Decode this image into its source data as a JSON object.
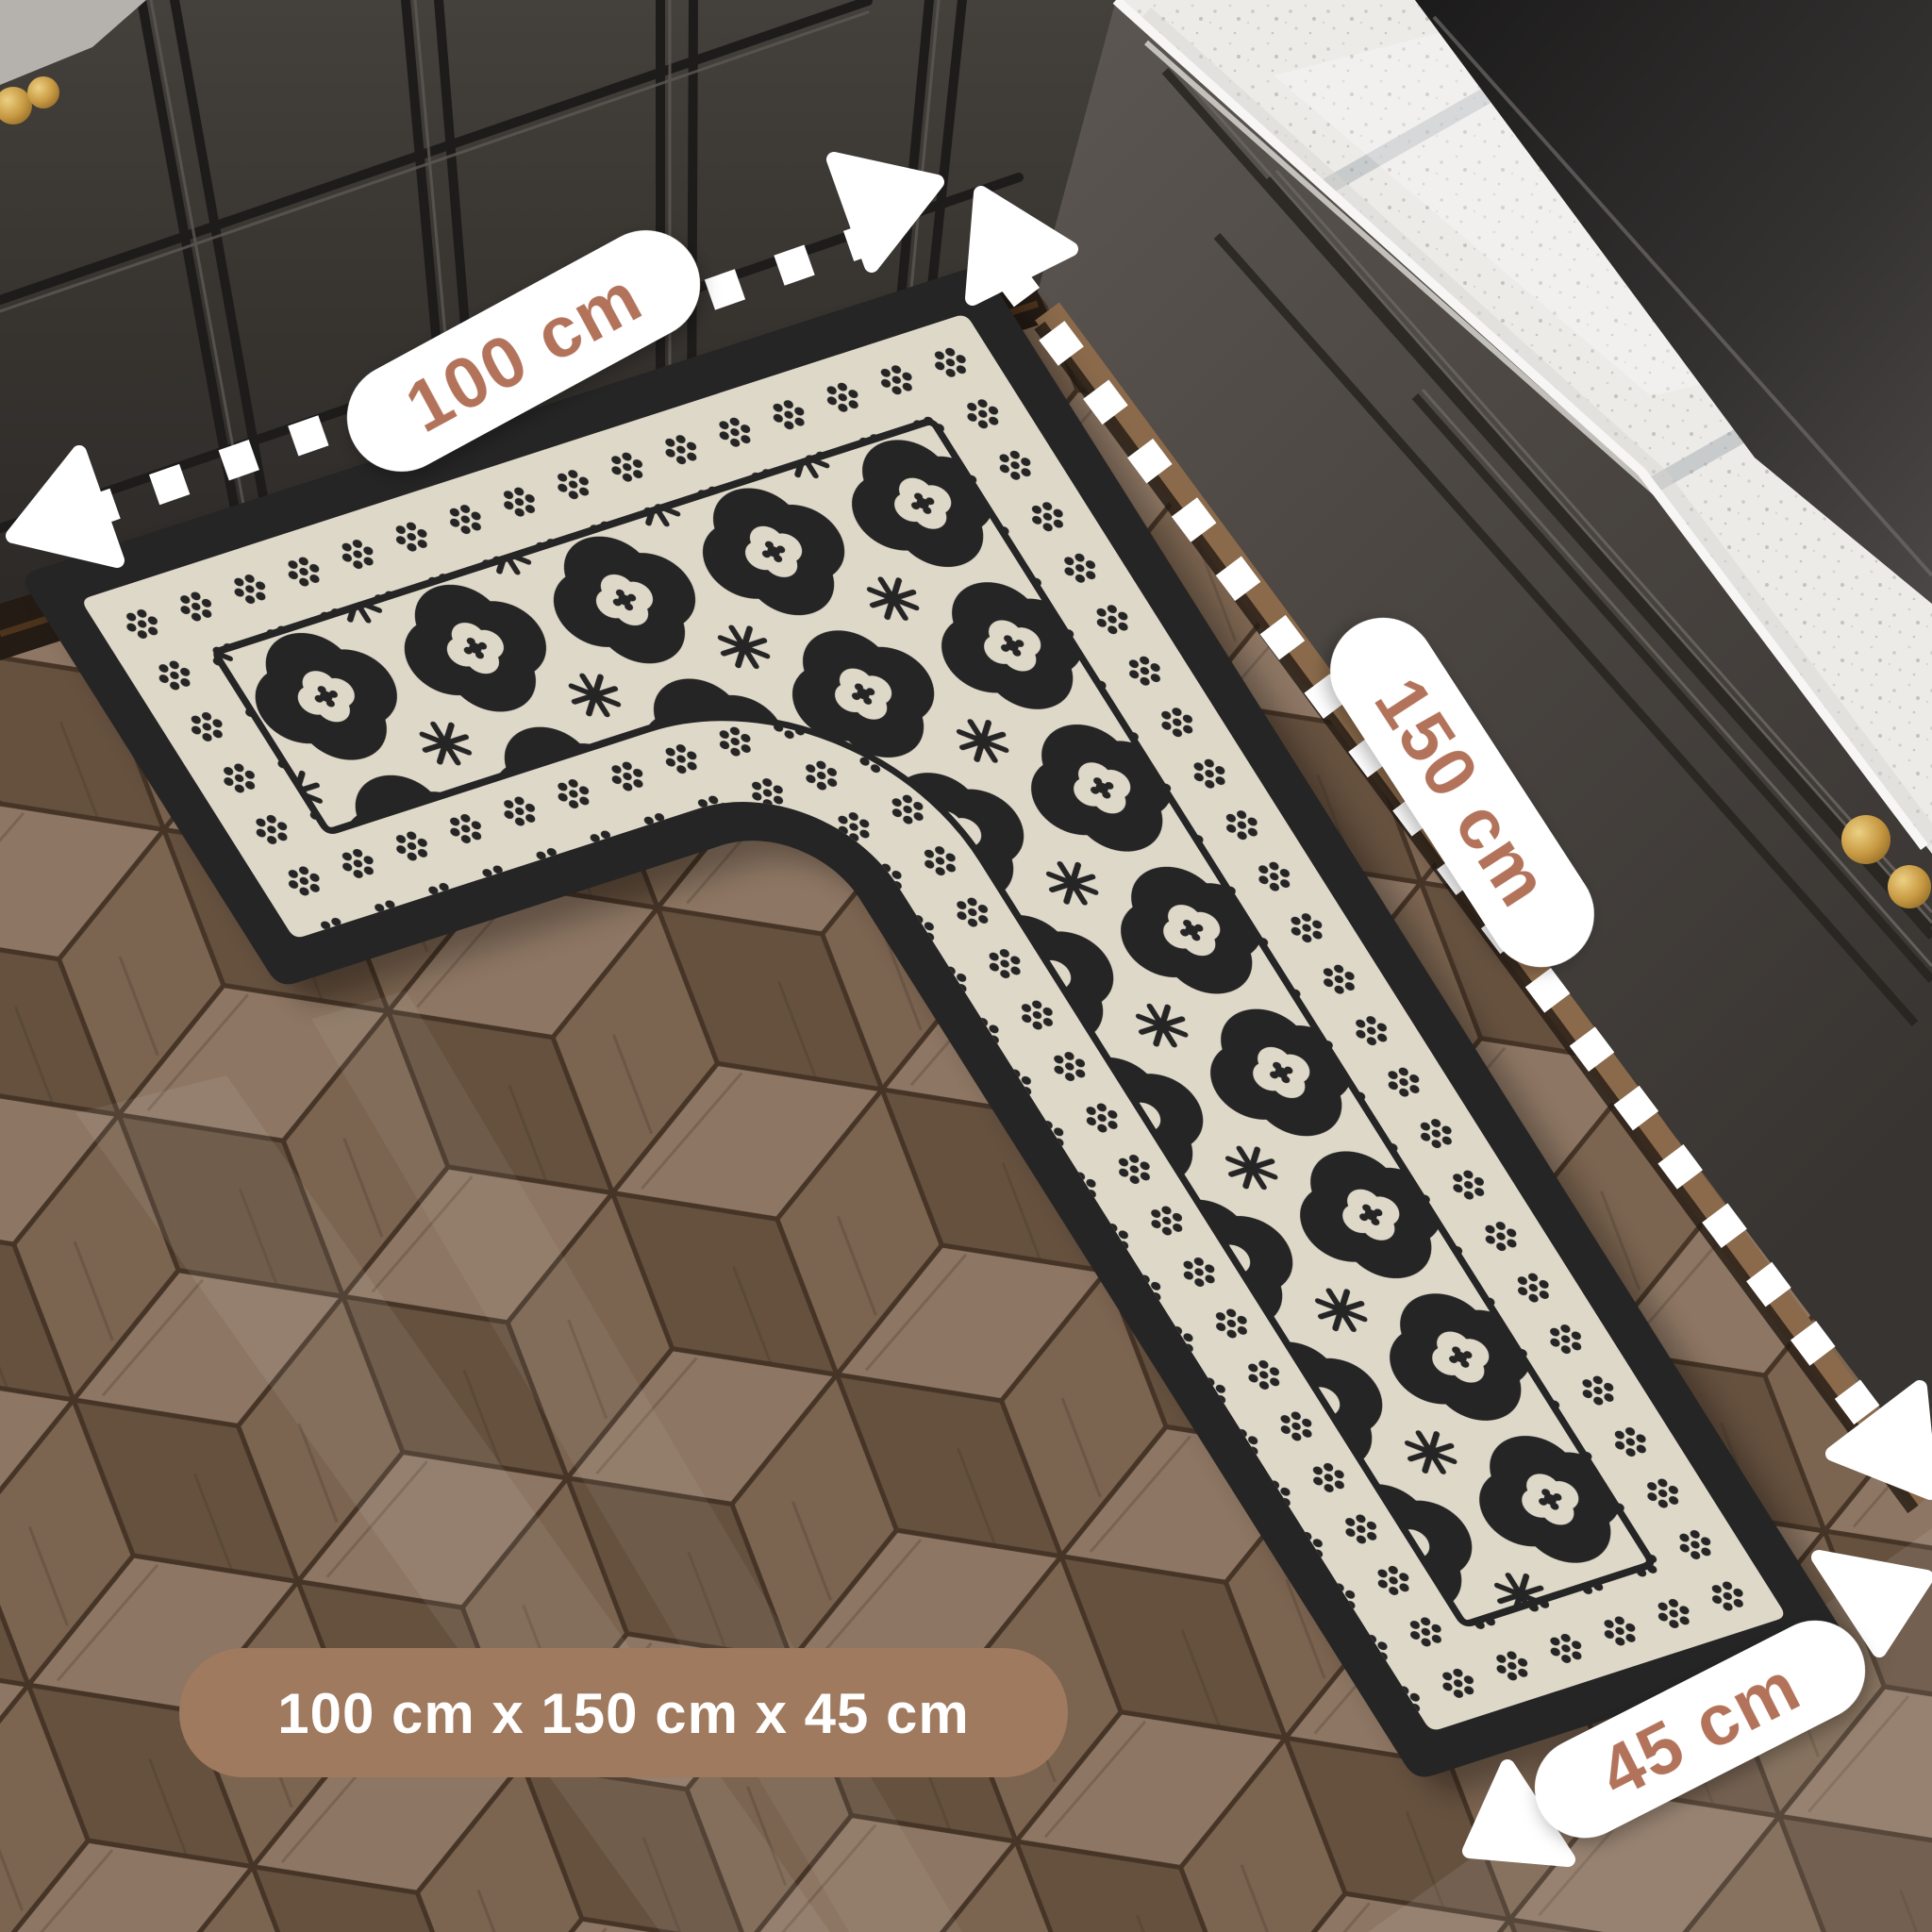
{
  "annotations": {
    "width_label": "100 cm",
    "length_label": "150 cm",
    "depth_label": "45 cm",
    "size_summary": "100 cm x 150 cm x 45 cm"
  },
  "colors": {
    "pill_bg": "#ffffff",
    "pill_text": "#b3735a",
    "summary_bg": "#a07a5e",
    "summary_text": "#ffffff",
    "dimension_line": "#ffffff",
    "mat_black": "#262525",
    "mat_cream": "#ded8c9",
    "cabinet_dark": "#38342f",
    "countertop_white": "#ecebe8",
    "cooktop_black": "#232221",
    "floor_wood_brown": "#75604f",
    "knob_gold": "#c89a43"
  },
  "icons": {
    "dimension_arrow": "▲"
  }
}
